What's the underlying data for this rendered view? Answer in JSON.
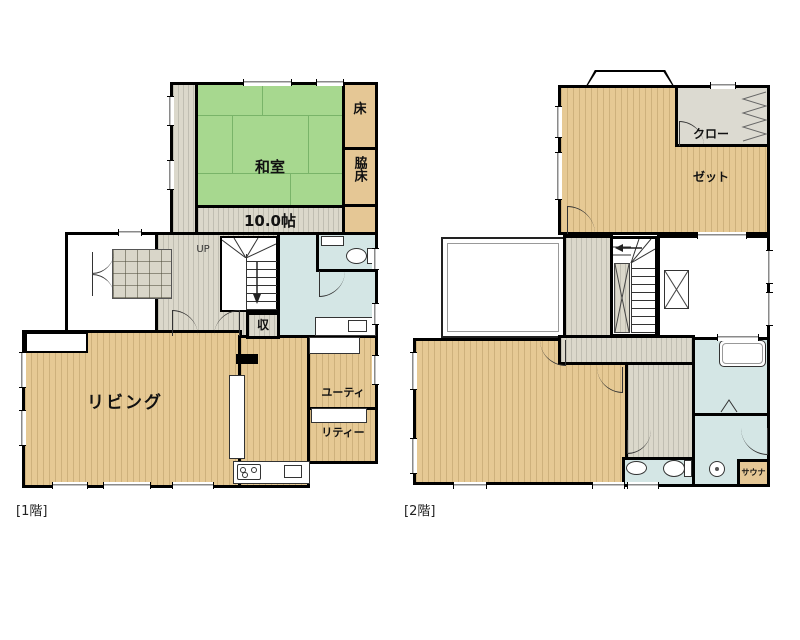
{
  "colors": {
    "wall": "#000000",
    "tatami": "#a7d88f",
    "wood": "#e6c994",
    "hall_floor": "#dbd8cb",
    "tile_blue": "#d4e6e5",
    "closet_gray": "#dcdad1",
    "toko_tan": "#e5c795"
  },
  "floor1": {
    "caption": "[1階]",
    "washitsu_name": "和室",
    "washitsu_size": "10.0帖",
    "toko": "床",
    "wakidoko": "脇床",
    "up": "UP",
    "storage": "収",
    "living": "リビング",
    "utility_line1": "ユーティ",
    "utility_line2": "リティー"
  },
  "floor2": {
    "caption": "[2階]",
    "closet_line1": "クロー",
    "closet_line2": "ゼット",
    "sauna": "サウナ"
  }
}
